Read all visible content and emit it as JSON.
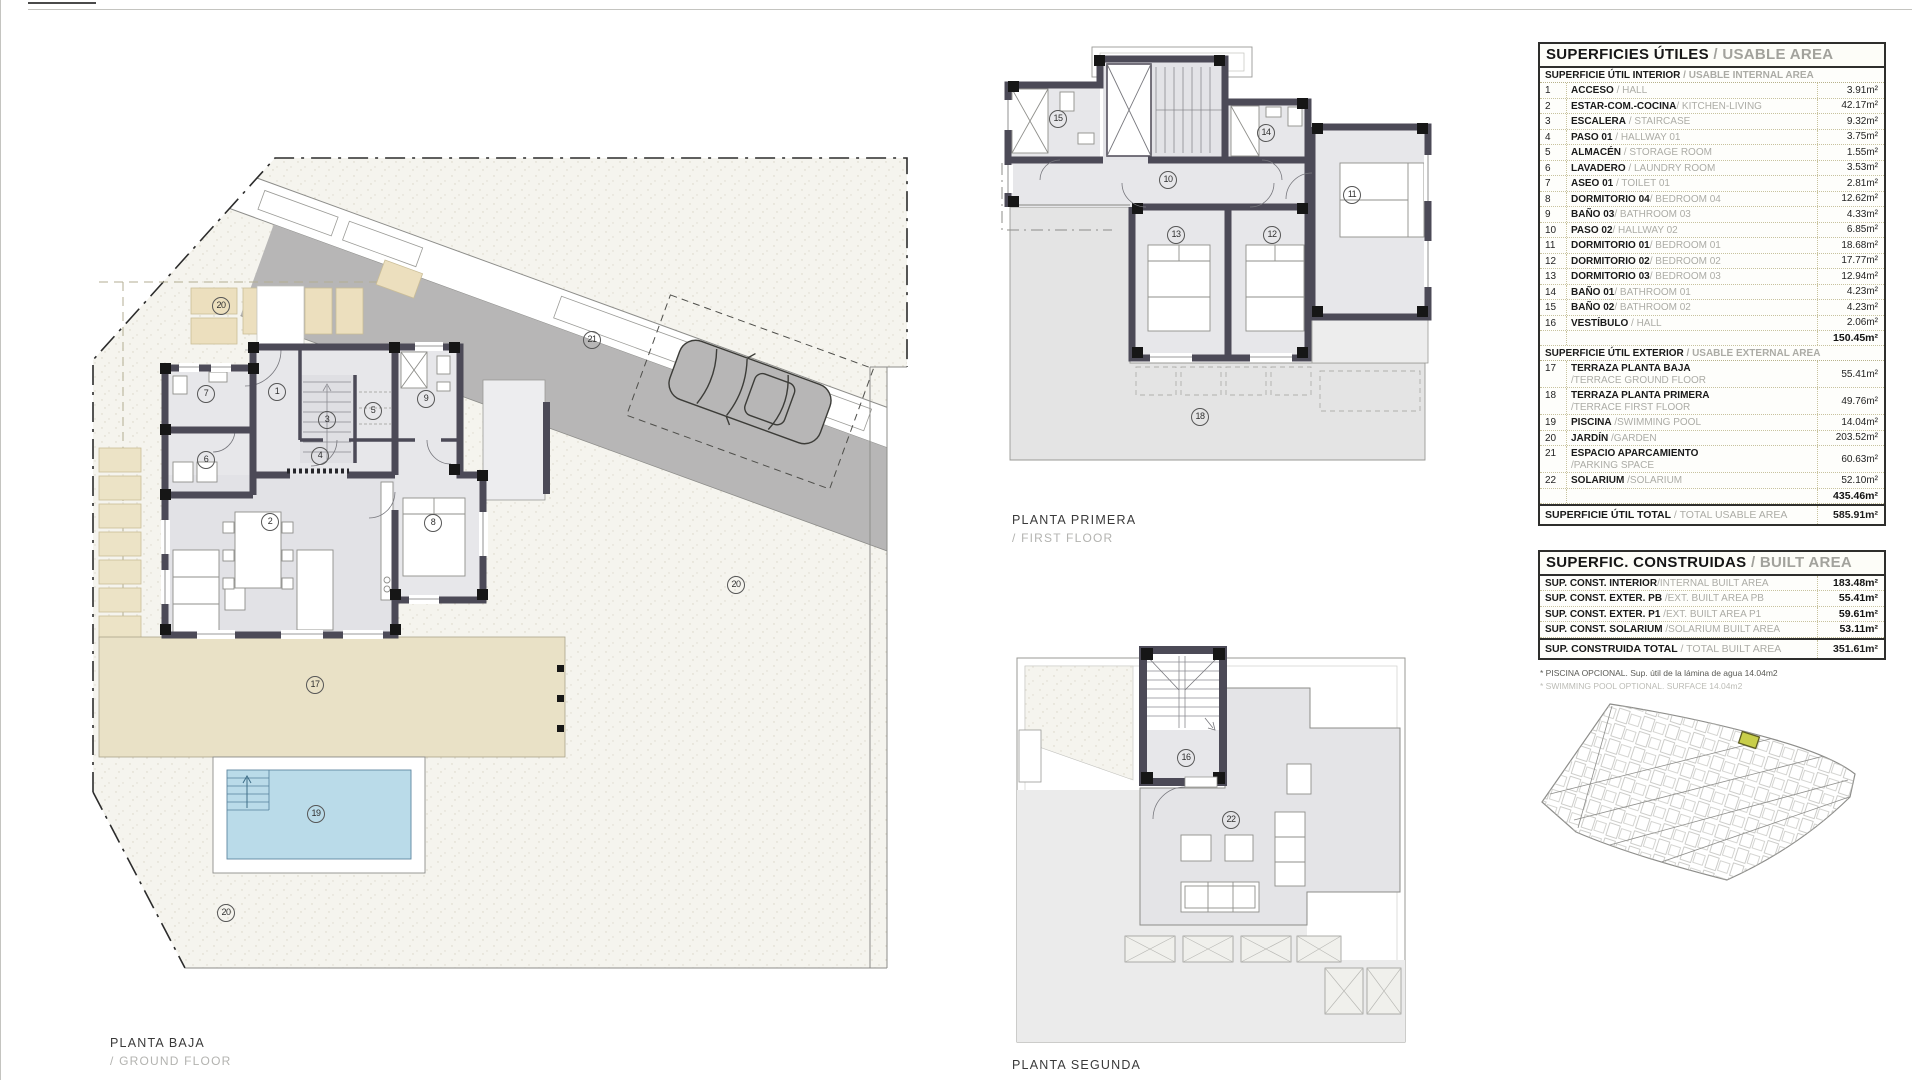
{
  "plans": {
    "ground": {
      "label": "PLANTA BAJA",
      "sub": "/ GROUND FLOOR",
      "markers": [
        {
          "x": 192,
          "y": 262,
          "label": "1"
        },
        {
          "x": 185,
          "y": 392,
          "label": "2"
        },
        {
          "x": 242,
          "y": 290,
          "label": "3"
        },
        {
          "x": 235,
          "y": 326,
          "label": "4"
        },
        {
          "x": 288,
          "y": 281,
          "label": "5"
        },
        {
          "x": 121,
          "y": 330,
          "label": "6"
        },
        {
          "x": 121,
          "y": 264,
          "label": "7"
        },
        {
          "x": 348,
          "y": 393,
          "label": "8"
        },
        {
          "x": 341,
          "y": 269,
          "label": "9"
        },
        {
          "x": 230,
          "y": 555,
          "label": "17"
        },
        {
          "x": 231,
          "y": 684,
          "label": "19"
        },
        {
          "x": 136,
          "y": 176,
          "label": "20"
        },
        {
          "x": 651,
          "y": 455,
          "label": "20"
        },
        {
          "x": 141,
          "y": 783,
          "label": "20"
        },
        {
          "x": 507,
          "y": 210,
          "label": "21"
        }
      ]
    },
    "first": {
      "label": "PLANTA PRIMERA",
      "sub": "/ FIRST FLOOR",
      "markers": [
        {
          "x": 58,
          "y": 74,
          "label": "15"
        },
        {
          "x": 266,
          "y": 88,
          "label": "14"
        },
        {
          "x": 168,
          "y": 135,
          "label": "10"
        },
        {
          "x": 352,
          "y": 150,
          "label": "11"
        },
        {
          "x": 176,
          "y": 190,
          "label": "13"
        },
        {
          "x": 272,
          "y": 190,
          "label": "12"
        },
        {
          "x": 200,
          "y": 372,
          "label": "18"
        }
      ]
    },
    "second": {
      "label": "PLANTA SEGUNDA",
      "sub": "",
      "markers": [
        {
          "x": 191,
          "y": 128,
          "label": "16"
        },
        {
          "x": 236,
          "y": 190,
          "label": "22"
        }
      ]
    }
  },
  "tables": {
    "usable": {
      "title_es": "SUPERFICIES ÚTILES",
      "title_en": " / USABLE AREA",
      "sections": [
        {
          "header_es": "SUPERFICIE ÚTIL INTERIOR",
          "header_en": " / USABLE INTERNAL AREA",
          "rows": [
            {
              "n": "1",
              "es": "ACCESO",
              "en": " / HALL",
              "value": "3.91m²"
            },
            {
              "n": "2",
              "es": "ESTAR-COM.-COCINA",
              "en": "/ KITCHEN-LIVING",
              "value": "42.17m²"
            },
            {
              "n": "3",
              "es": "ESCALERA",
              "en": " / STAIRCASE",
              "value": "9.32m²"
            },
            {
              "n": "4",
              "es": "PASO 01",
              "en": " / HALLWAY 01",
              "value": "3.75m²"
            },
            {
              "n": "5",
              "es": "ALMACÉN",
              "en": " / STORAGE ROOM",
              "value": "1.55m²"
            },
            {
              "n": "6",
              "es": "LAVADERO",
              "en": " / LAUNDRY ROOM",
              "value": "3.53m²"
            },
            {
              "n": "7",
              "es": "ASEO 01",
              "en": " / TOILET 01",
              "value": "2.81m²"
            },
            {
              "n": "8",
              "es": "DORMITORIO 04",
              "en": "/ BEDROOM 04",
              "value": "12.62m²"
            },
            {
              "n": "9",
              "es": "BAÑO 03",
              "en": "/ BATHROOM 03",
              "value": "4.33m²"
            },
            {
              "n": "10",
              "es": "PASO 02",
              "en": "/ HALLWAY 02",
              "value": "6.85m²"
            },
            {
              "n": "11",
              "es": "DORMITORIO 01",
              "en": "/ BEDROOM 01",
              "value": "18.68m²"
            },
            {
              "n": "12",
              "es": "DORMITORIO 02",
              "en": "/ BEDROOM 02",
              "value": "17.77m²"
            },
            {
              "n": "13",
              "es": "DORMITORIO 03",
              "en": "/ BEDROOM 03",
              "value": "12.94m²"
            },
            {
              "n": "14",
              "es": "BAÑO 01",
              "en": "/ BATHROOM 01",
              "value": "4.23m²"
            },
            {
              "n": "15",
              "es": "BAÑO 02",
              "en": "/ BATHROOM 02",
              "value": "4.23m²"
            },
            {
              "n": "16",
              "es": "VESTÍBULO",
              "en": " / HALL",
              "value": "2.06m²"
            }
          ],
          "subtotal": "150.45m²"
        },
        {
          "header_es": "SUPERFICIE ÚTIL EXTERIOR",
          "header_en": " / USABLE EXTERNAL AREA",
          "rows": [
            {
              "n": "17",
              "es": "TERRAZA PLANTA BAJA",
              "en": "/TERRACE GROUND FLOOR",
              "value": "55.41m²",
              "wrap": true
            },
            {
              "n": "18",
              "es": "TERRAZA PLANTA PRIMERA",
              "en": "/TERRACE FIRST FLOOR",
              "value": "49.76m²",
              "wrap": true
            },
            {
              "n": "19",
              "es": "PISCINA",
              "en": " /SWIMMING POOL",
              "value": "14.04m²"
            },
            {
              "n": "20",
              "es": "JARDÍN",
              "en": " /GARDEN",
              "value": "203.52m²"
            },
            {
              "n": "21",
              "es": "ESPACIO APARCAMIENTO",
              "en": "/PARKING SPACE",
              "value": "60.63m²",
              "wrap": true
            },
            {
              "n": "22",
              "es": "SOLARIUM",
              "en": " /SOLARIUM",
              "value": "52.10m²"
            }
          ],
          "subtotal": "435.46m²"
        }
      ],
      "total_es": "SUPERFICIE ÚTIL TOTAL",
      "total_en": " / TOTAL USABLE AREA",
      "total_value": "585.91m²"
    },
    "built": {
      "title_es": "SUPERFIC. CONSTRUIDAS",
      "title_en": " / BUILT AREA",
      "rows": [
        {
          "es": "SUP. CONST. INTERIOR",
          "en": "/INTERNAL BUILT AREA",
          "value": "183.48m²"
        },
        {
          "es": "SUP. CONST. EXTER. PB",
          "en": " /EXT. BUILT AREA PB",
          "value": "55.41m²"
        },
        {
          "es": "SUP. CONST. EXTER. P1",
          "en": " /EXT. BUILT AREA P1",
          "value": "59.61m²"
        },
        {
          "es": "SUP. CONST. SOLARIUM",
          "en": " /SOLARIUM BUILT AREA",
          "value": "53.11m²"
        }
      ],
      "total_es": "SUP. CONSTRUIDA TOTAL",
      "total_en": " / TOTAL BUILT AREA",
      "total_value": "351.61m²"
    }
  },
  "footnotes": [
    {
      "text": "* PISCINA OPCIONAL. Sup. útil de la lámina de agua 14.04m2",
      "tone": "dark"
    },
    {
      "text": "* SWIMMING POOL OPTIONAL. SURFACE 14.04m2",
      "tone": "light"
    }
  ],
  "colors": {
    "wall": "#4c4a57",
    "room_fill": "#e7e7ea",
    "terrace_beige": "#e9e1c6",
    "pool_blue": "#badbe9",
    "parking_gray": "#b7b6b6",
    "site_highlight": "#c8ce4a"
  }
}
